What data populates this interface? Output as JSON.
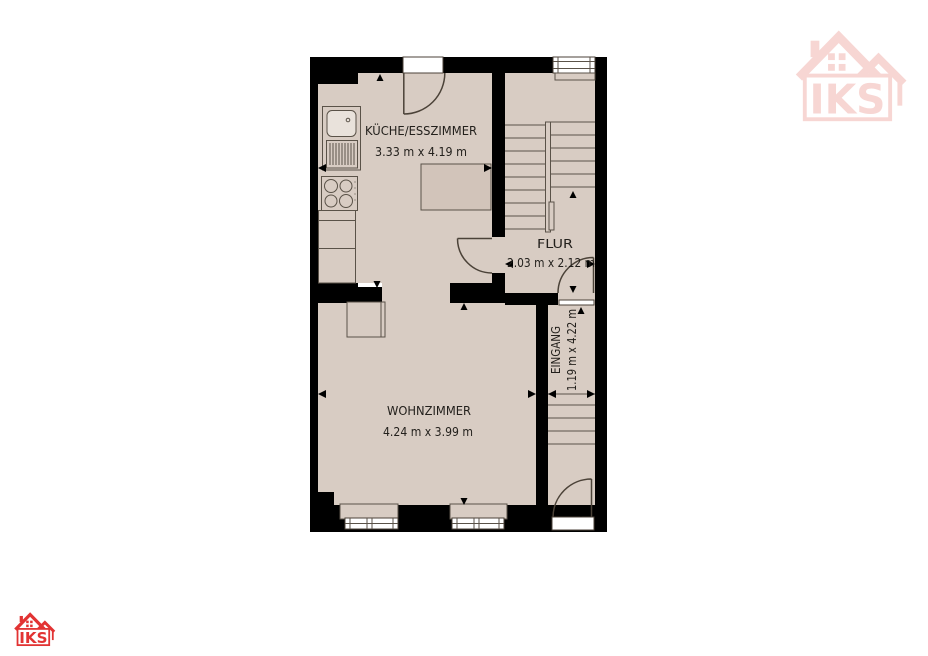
{
  "page": {
    "background_color": "#ffffff"
  },
  "branding": {
    "logo_text": "IKS",
    "logo_color": "#e23333",
    "watermark_color": "#f7d6d3"
  },
  "floorplan": {
    "colors": {
      "wall": "#000000",
      "floor": "#d8ccc3",
      "line": "#4b4238",
      "fixture_line": "#5a5248",
      "label": "#23201c"
    },
    "rooms": {
      "kitchen": {
        "name": "KÜCHE/ESSZIMMER",
        "dimensions": "3.33 m x 4.19 m"
      },
      "hallway": {
        "name": "FLUR",
        "dimensions": "2.03 m x 2.12 m"
      },
      "living_room": {
        "name": "WOHNZIMMER",
        "dimensions": "4.24 m x 3.99 m"
      },
      "entrance": {
        "name": "EINGANG",
        "dimensions": "1.19 m x 4.22 m"
      }
    }
  }
}
